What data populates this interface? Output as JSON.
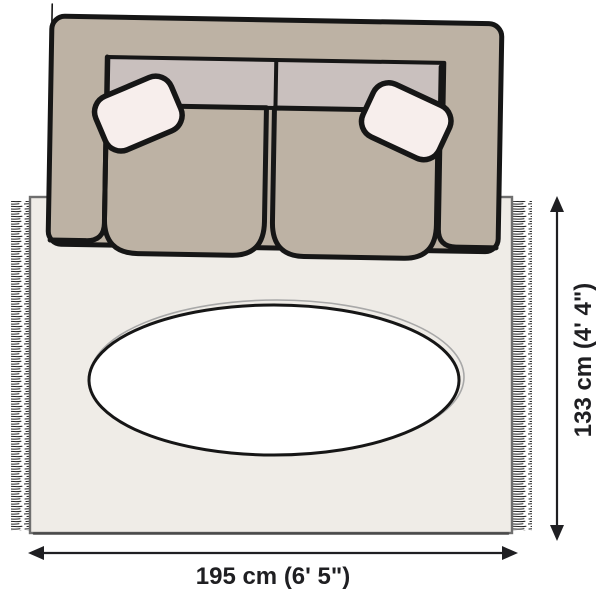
{
  "illustration": {
    "rug": {
      "width_label": "195 cm (6' 5\")",
      "height_label": "133 cm (4' 4\")"
    },
    "colors": {
      "canvas": "#ffffff",
      "rug": "#efece7",
      "rug_edge": "#6f6f6f",
      "fringe": "#222222",
      "sofa_body": "#bdb2a4",
      "sofa_back": "#c9c0be",
      "pillow": "#f7eeec",
      "table": "#ffffff",
      "outline": "#161616",
      "dimension": "#1f1f22"
    }
  }
}
